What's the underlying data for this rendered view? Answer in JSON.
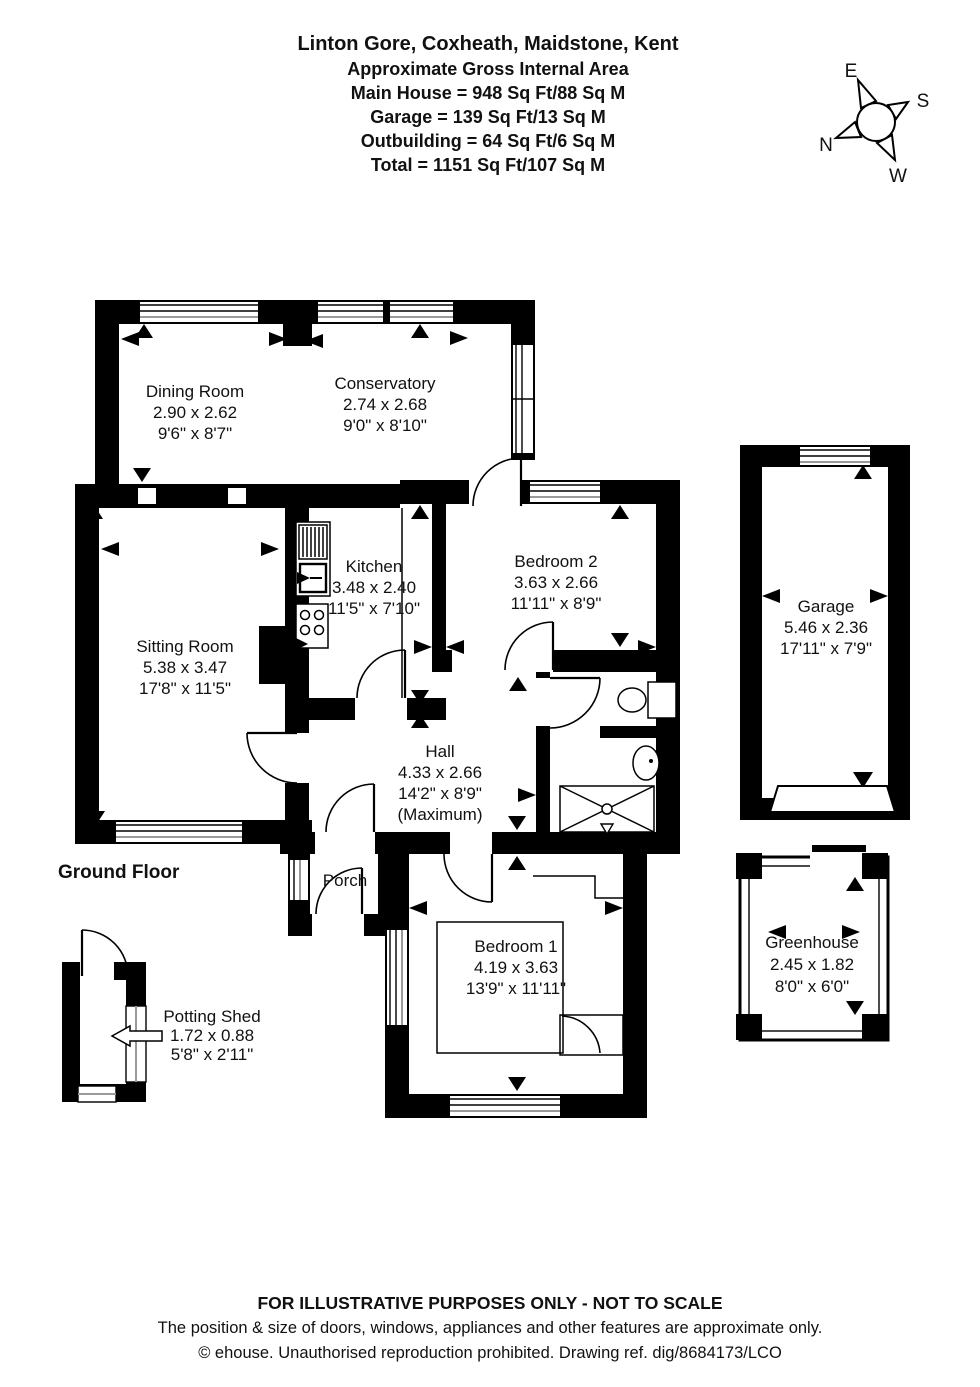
{
  "header": {
    "address": "Linton Gore, Coxheath, Maidstone, Kent",
    "subtitle": "Approximate Gross Internal Area",
    "areas": [
      "Main House = 948 Sq Ft/88 Sq M",
      "Garage = 139 Sq Ft/13 Sq M",
      "Outbuilding = 64 Sq Ft/6 Sq M",
      "Total = 1151 Sq Ft/107 Sq M"
    ]
  },
  "compass": {
    "n": "N",
    "e": "E",
    "s": "S",
    "w": "W"
  },
  "floor_label": "Ground Floor",
  "rooms": {
    "dining_room": {
      "name": "Dining Room",
      "metric": "2.90 x 2.62",
      "imperial": "9'6\" x 8'7\""
    },
    "conservatory": {
      "name": "Conservatory",
      "metric": "2.74 x 2.68",
      "imperial": "9'0\" x 8'10\""
    },
    "kitchen": {
      "name": "Kitchen",
      "metric": "3.48 x 2.40",
      "imperial": "11'5\" x 7'10\""
    },
    "sitting_room": {
      "name": "Sitting Room",
      "metric": "5.38 x 3.47",
      "imperial": "17'8\" x 11'5\""
    },
    "bedroom_2": {
      "name": "Bedroom 2",
      "metric": "3.63 x 2.66",
      "imperial": "11'11\" x 8'9\""
    },
    "hall": {
      "name": "Hall",
      "metric": "4.33 x 2.66",
      "imperial": "14'2\" x 8'9\"",
      "note": "(Maximum)"
    },
    "porch": {
      "name": "Porch"
    },
    "bedroom_1": {
      "name": "Bedroom 1",
      "metric": "4.19 x 3.63",
      "imperial": "13'9\" x 11'11\""
    },
    "garage": {
      "name": "Garage",
      "metric": "5.46 x 2.36",
      "imperial": "17'11\" x 7'9\""
    },
    "greenhouse": {
      "name": "Greenhouse",
      "metric": "2.45 x 1.82",
      "imperial": "8'0\" x 6'0\""
    },
    "potting_shed": {
      "name": "Potting Shed",
      "metric": "1.72 x 0.88",
      "imperial": "5'8\" x 2'11\""
    }
  },
  "footer": {
    "line1": "FOR ILLUSTRATIVE PURPOSES ONLY - NOT TO SCALE",
    "line2": "The position & size of doors, windows, appliances and other features are approximate only.",
    "line3": "© ehouse. Unauthorised reproduction prohibited. Drawing ref. dig/8684173/LCO"
  }
}
